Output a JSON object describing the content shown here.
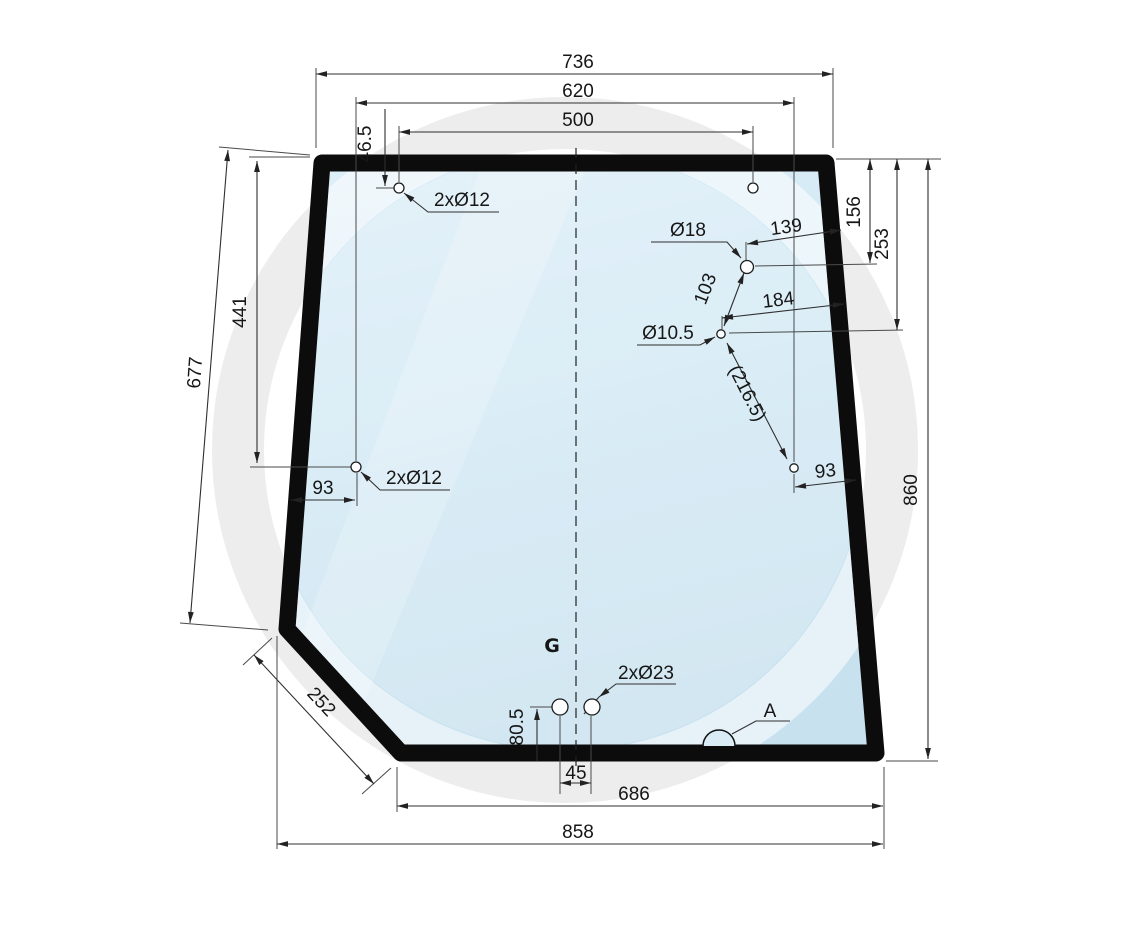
{
  "drawing": {
    "watermark_letter": "G",
    "dims": {
      "top_width": "736",
      "side_holes_span": "620",
      "top_holes_span": "500",
      "top_hole_offset": "46.5",
      "top_holes": "2xØ12",
      "side_hole_dia": "Ø18",
      "side_hole_edge_dist": "139",
      "side_hole_top_dist": "156",
      "lower_hole_top_dist": "253",
      "holes_gap": "103",
      "lower_hole_edge_dist": "184",
      "lower_hole_dia": "Ø10.5",
      "diag_gap": "(216.5)",
      "right_hole_edge_dist": "93",
      "right_height": "860",
      "left_hole_top_dist": "441",
      "left_edge_length": "677",
      "left_holes": "2xØ12",
      "left_hole_edge_dist": "93",
      "corner_cut_length": "252",
      "bottom_holes": "2xØ23",
      "bottom_holes_offset": "80.5",
      "bottom_holes_gap": "45",
      "notch_label": "A",
      "bottom_inner_width": "686",
      "bottom_outer_width": "858"
    }
  }
}
